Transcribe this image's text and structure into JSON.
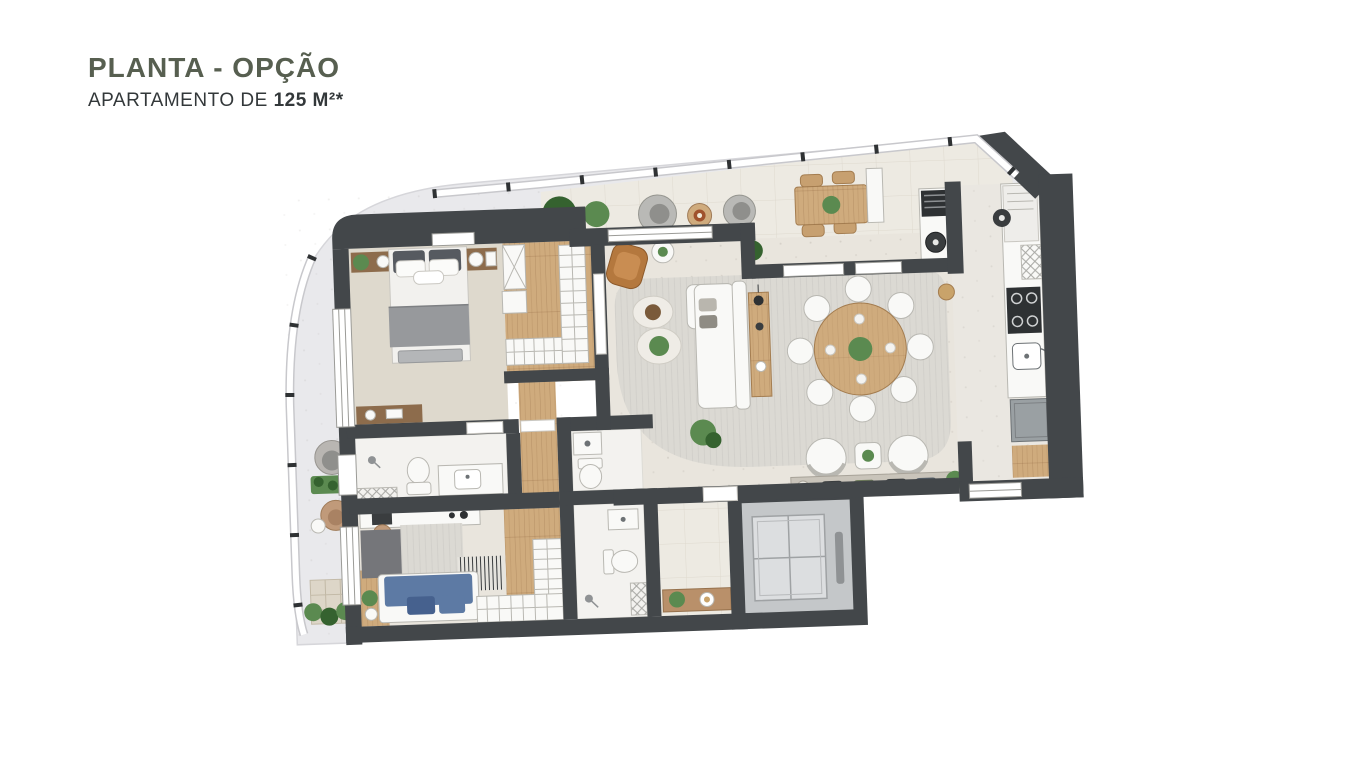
{
  "header": {
    "title": "PLANTA - OPÇÃO",
    "subtitle_prefix": "APARTAMENTO DE ",
    "subtitle_area": "125 M²*"
  },
  "colors": {
    "title": "#575f50",
    "text": "#33383a",
    "wall": "#43474a",
    "outdoor": "#e9e9ec",
    "terrace": "#edeae2",
    "tileline": "#ded9cf",
    "floor": "#e9e5dd",
    "kitchenfloor": "#eae7e1",
    "carpet": "#ded9cd",
    "wood": "#cfab7d",
    "wooddark": "#8d6c4c",
    "marble": "#f3f2ef",
    "rug": "#dbd9d3",
    "rugdark": "#75767a",
    "white": "#f9f9f7",
    "stroke": "#b9b8b2",
    "blue": "#5d7aa4",
    "blue2": "#46618e",
    "leather": "#b4783e",
    "plant": "#5b8a50",
    "plant2": "#35622f",
    "graybox": "#9aa0a3",
    "cab": "#c4c7c9",
    "cabin": "#dcdee0",
    "grill": "#2e3133",
    "rail": "#ffffff",
    "railtick": "#2f3234"
  }
}
